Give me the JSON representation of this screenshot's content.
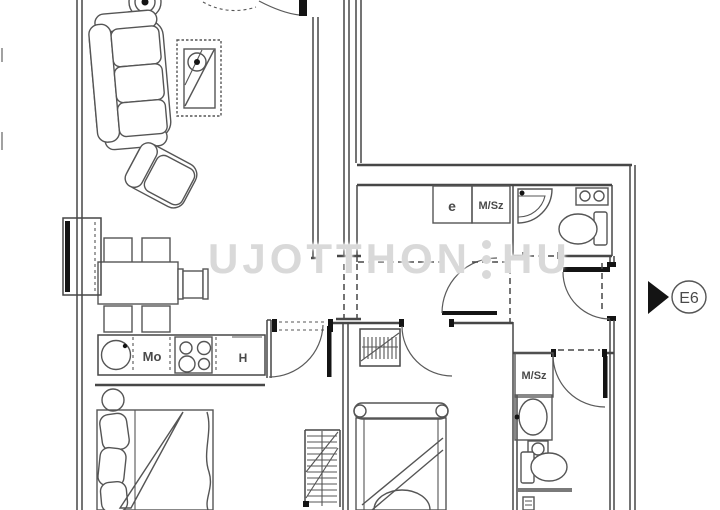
{
  "watermark": {
    "part1": "UJOTTHON",
    "part2": "HU"
  },
  "labels": {
    "closet_e": "e",
    "msz_top": "M/Sz",
    "kitchen_sink": "Mo",
    "kitchen_fridge": "H",
    "msz_bottom": "M/Sz",
    "entrance_code": "E6"
  },
  "colors": {
    "wall": "#474747",
    "furniture": "#555555",
    "jamb": "#141414",
    "label": "#4a4a4a",
    "watermark": "#d9d9d9",
    "background": "#ffffff"
  }
}
